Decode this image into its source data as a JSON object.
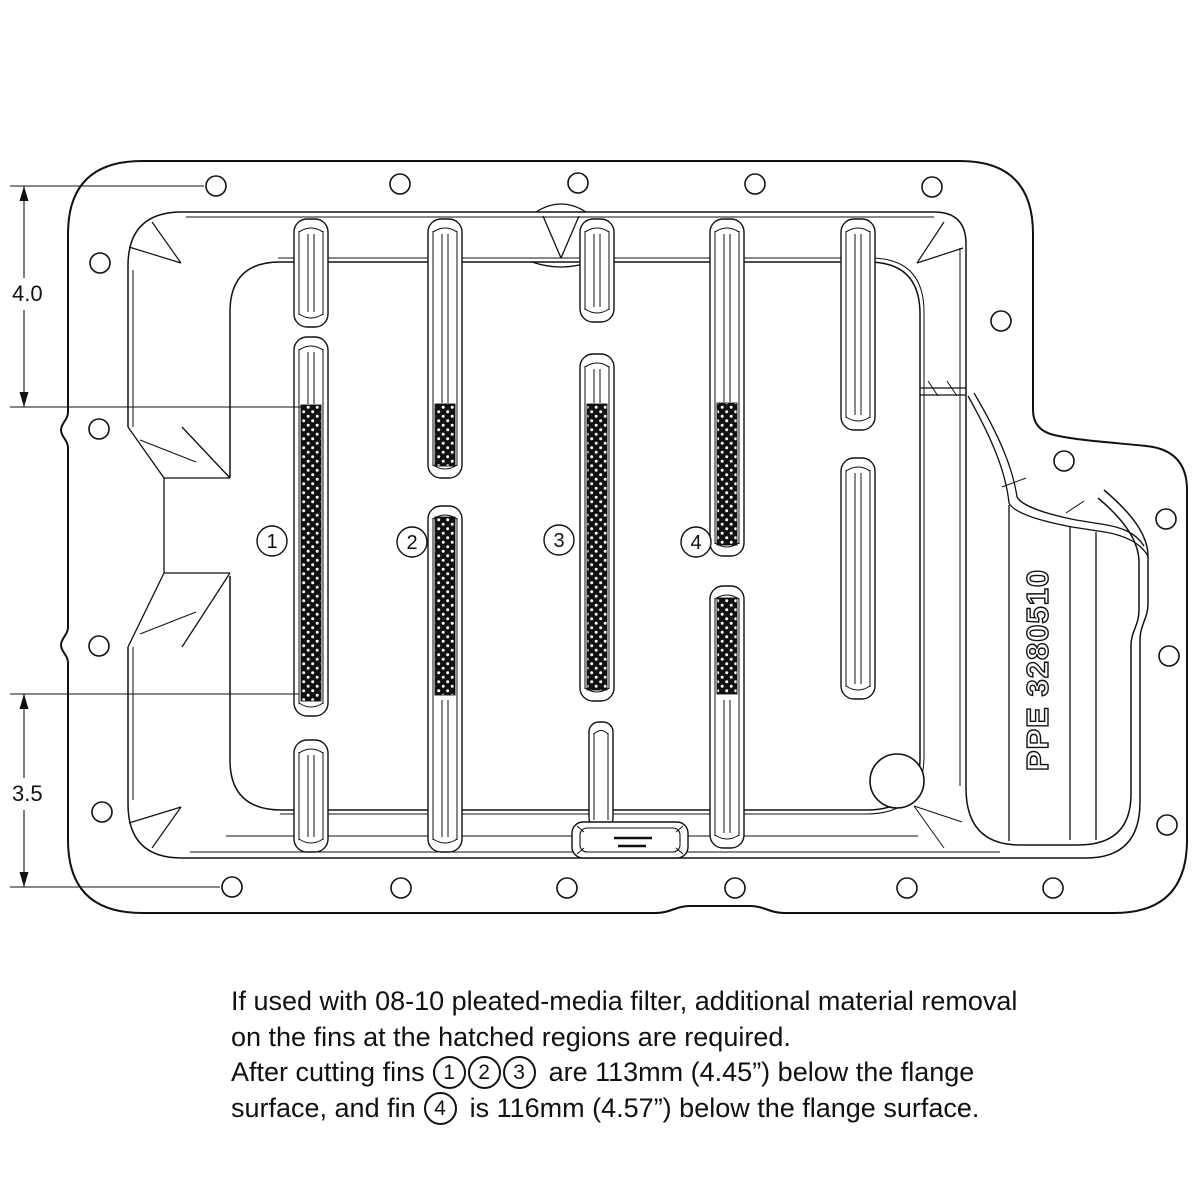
{
  "drawing": {
    "part_number": "PPE 3280510",
    "dim_upper": "4.0",
    "dim_lower": "3.5",
    "fin_callouts": [
      "1",
      "2",
      "3",
      "4"
    ]
  },
  "notes": {
    "line1": "If used with 08-10 pleated-media filter, additional material removal",
    "line2": "on the fins at the hatched regions are required.",
    "line3_before": "After cutting fins",
    "circle1": "1",
    "circle2": "2",
    "circle3": "3",
    "line3_after": "are 113mm (4.45”) below the flange",
    "line4_before": "surface, and fin",
    "circle4": "4",
    "line4_after": "is 116mm (4.57”) below the flange surface."
  }
}
